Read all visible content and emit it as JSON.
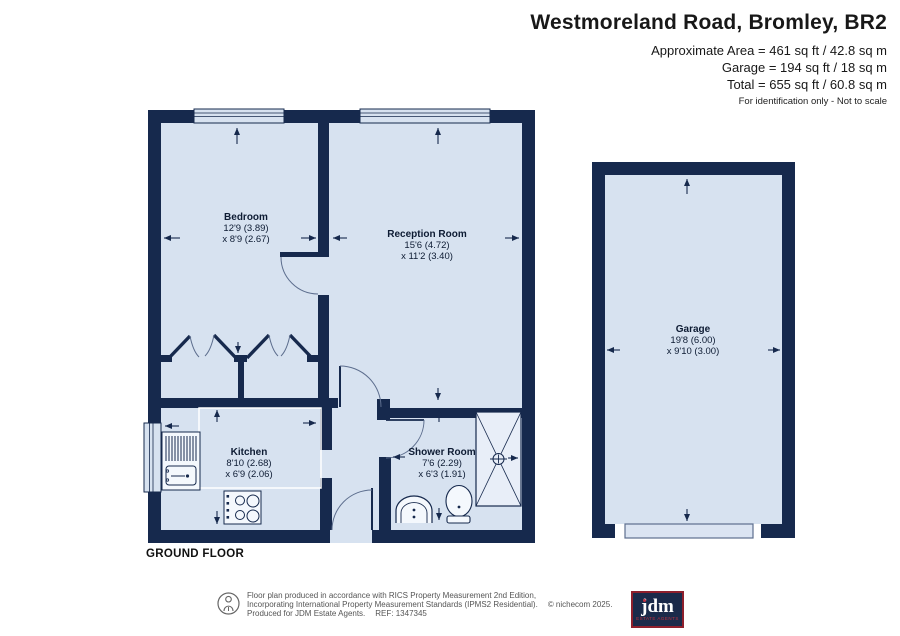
{
  "header": {
    "title": "Westmoreland Road, Bromley, BR2",
    "area_lines": [
      "Approximate Area = 461 sq ft / 42.8 sq m",
      "Garage = 194 sq ft / 18 sq m",
      "Total = 655 sq ft / 60.8 sq m"
    ],
    "note": "For identification only - Not to scale"
  },
  "rooms": {
    "bedroom": {
      "name": "Bedroom",
      "dim1": "12'9 (3.89)",
      "dim2": "x 8'9 (2.67)"
    },
    "reception": {
      "name": "Reception Room",
      "dim1": "15'6 (4.72)",
      "dim2": "x 11'2 (3.40)"
    },
    "kitchen": {
      "name": "Kitchen",
      "dim1": "8'10 (2.68)",
      "dim2": "x 6'9 (2.06)"
    },
    "shower": {
      "name": "Shower Room",
      "dim1": "7'6 (2.29)",
      "dim2": "x 6'3 (1.91)"
    },
    "garage": {
      "name": "Garage",
      "dim1": "19'8 (6.00)",
      "dim2": "x 9'10 (3.00)"
    }
  },
  "floor_label": "GROUND FLOOR",
  "footer": {
    "line1": "Floor plan produced in accordance with RICS Property Measurement 2nd Edition,",
    "line2": "Incorporating International Property Measurement Standards (IPMS2 Residential).",
    "copyright": "© nichecom 2025.",
    "line3": "Produced for JDM Estate Agents.",
    "ref": "REF: 1347345",
    "logo": {
      "word": "jdm",
      "sub": "ESTATE AGENTS"
    }
  },
  "icons": {
    "footer_badge": "person-icon"
  },
  "colors": {
    "wall": "#16294d",
    "room_fill": "#d7e2f0",
    "thin_line": "#5d6e8e",
    "logo_red": "#8e1f2c"
  }
}
